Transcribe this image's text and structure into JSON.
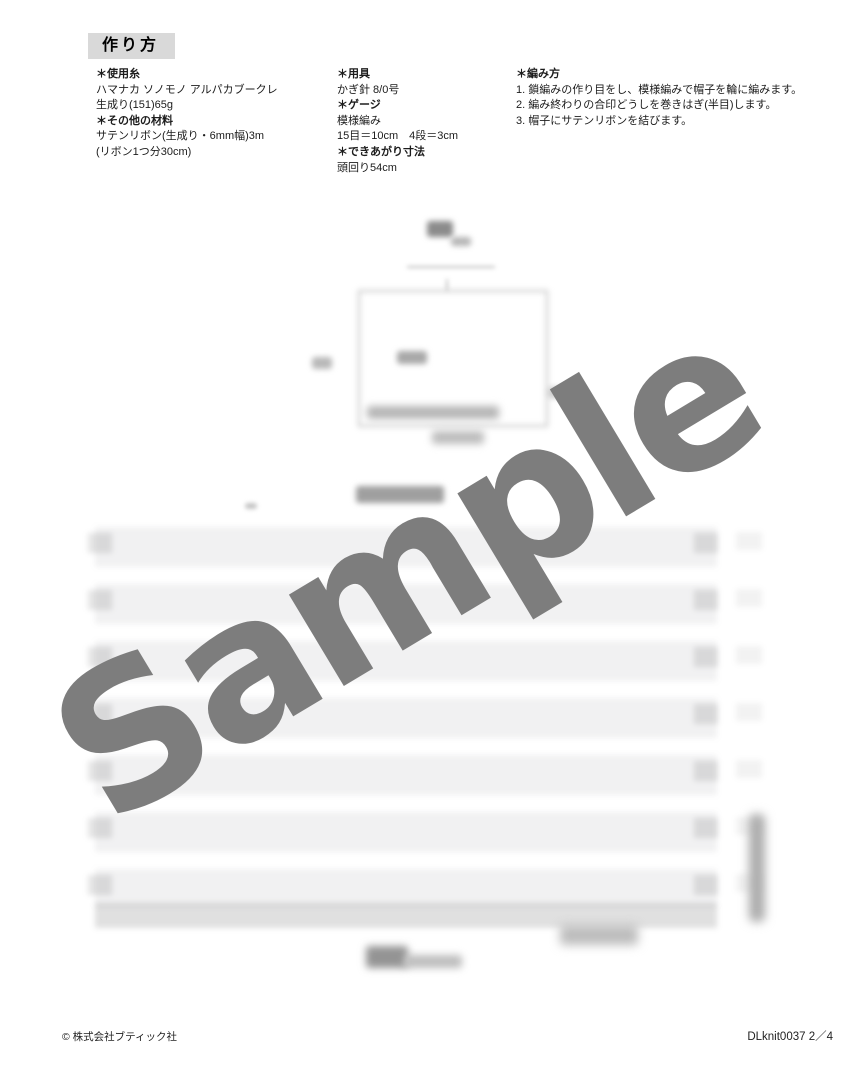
{
  "header": {
    "title": "作り方"
  },
  "materials": {
    "yarn_heading": "＊使用糸",
    "yarn_lines": [
      "ハマナカ ソノモノ アルパカブークレ",
      "生成り(151)65g"
    ],
    "other_heading": "＊その他の材料",
    "other_lines": [
      "サテンリボン(生成り・6mm幅)3m",
      "(リボン1つ分30cm)"
    ]
  },
  "tools": {
    "tools_heading": "＊用具",
    "tools_value": "かぎ針 8/0号",
    "gauge_heading": "＊ゲージ",
    "gauge_lines": [
      "模様編み",
      "15目＝10cm　4段＝3cm"
    ],
    "size_heading": "＊できあがり寸法",
    "size_value": "頭回り54cm"
  },
  "instructions": {
    "heading": "＊編み方",
    "steps": [
      "1. 鎖編みの作り目をし、模様編みで帽子を輪に編みます。",
      "2. 編み終わりの合印どうしを巻きはぎ(半目)します。",
      "3. 帽子にサテンリボンを結びます。"
    ]
  },
  "watermark": {
    "text": "Sample",
    "color": "#7d7d7d"
  },
  "footer": {
    "copyright": "© 株式会社ブティック社",
    "page_id": "DLknit0037 2／4"
  }
}
